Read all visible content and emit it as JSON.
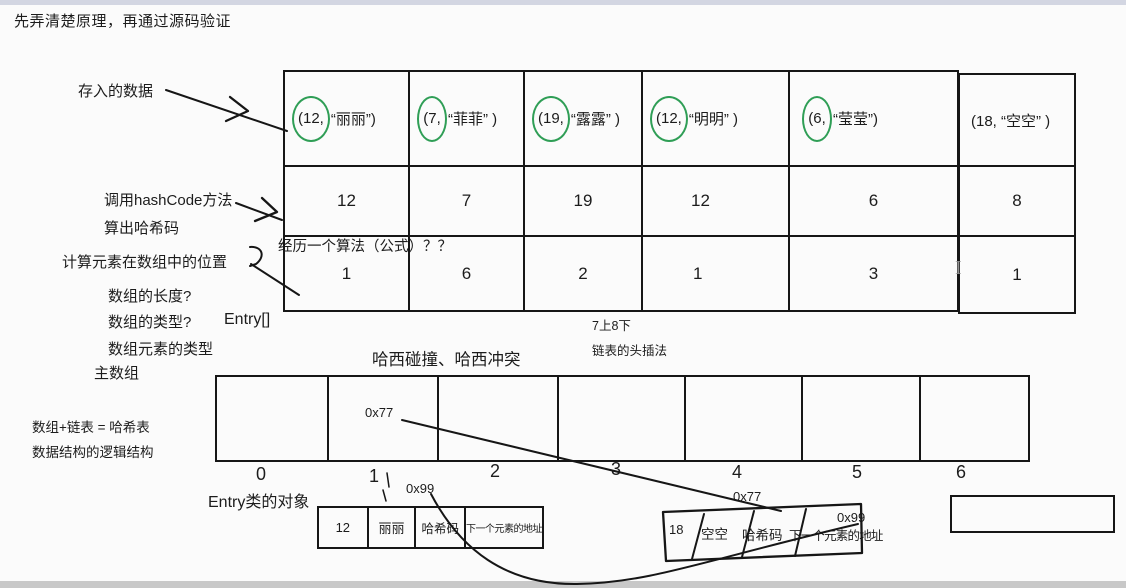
{
  "title": "先弄清楚原理，再通过源码验证",
  "colors": {
    "circle_green": "#2f9e56",
    "top_bar": "#d3d6e2",
    "bottom_bar": "#c8c8c8",
    "ink": "#1c1c1c"
  },
  "annotations": {
    "stored_data": "存入的数据",
    "call_hashcode": "调用hashCode方法",
    "compute_hash": "算出哈希码",
    "compute_position": "计算元素在数组中的位置",
    "array_length": "数组的长度?",
    "array_type": "数组的类型?",
    "entry_array_type": "Entry[]",
    "element_type": "数组元素的类型",
    "main_array_label": "主数组",
    "formula_note": "经历一个算法（公式）？？",
    "hash_collision": "哈西碰撞、哈西冲突",
    "seven_up_eight_down": "7上8下",
    "head_insertion": "链表的头插法",
    "array_plus_list": "数组+链表 = 哈希表",
    "logical_structure": "数据结构的逻辑结构",
    "entry_object": "Entry类的对象",
    "text_cursor": "I"
  },
  "hash_table": {
    "columns": [
      {
        "pair_prefix": "(12,",
        "pair_rest": "“丽丽”)",
        "hash": "12",
        "slot": "1",
        "circled": true
      },
      {
        "pair_prefix": "(7,",
        "pair_rest": "“菲菲” )",
        "hash": "7",
        "slot": "6",
        "circled": true
      },
      {
        "pair_prefix": "(19,",
        "pair_rest": "“露露” )",
        "hash": "19",
        "slot": "2",
        "circled": true
      },
      {
        "pair_prefix": "(12,",
        "pair_rest": "“明明” )",
        "hash": "12",
        "slot": "1",
        "circled": true
      },
      {
        "pair_prefix": "(6,",
        "pair_rest": "“莹莹”)",
        "hash": "6",
        "slot": "3",
        "circled": true
      },
      {
        "pair_full": "(18,  “空空” )",
        "hash": "8",
        "slot": "1",
        "circled": false
      }
    ]
  },
  "main_array": {
    "pointer_slot1": "0x77",
    "indices": [
      "0",
      "1",
      "2",
      "3",
      "4",
      "5",
      "6"
    ]
  },
  "entries": {
    "entry1": {
      "address": "0x99",
      "fields": [
        "12",
        "丽丽",
        "哈希码",
        "下一个元素的地址"
      ]
    },
    "entry2": {
      "address": "0x77",
      "next_address": "0x99",
      "fields": [
        "18",
        "空空",
        "哈希码",
        "下一个元素的地址"
      ]
    }
  }
}
